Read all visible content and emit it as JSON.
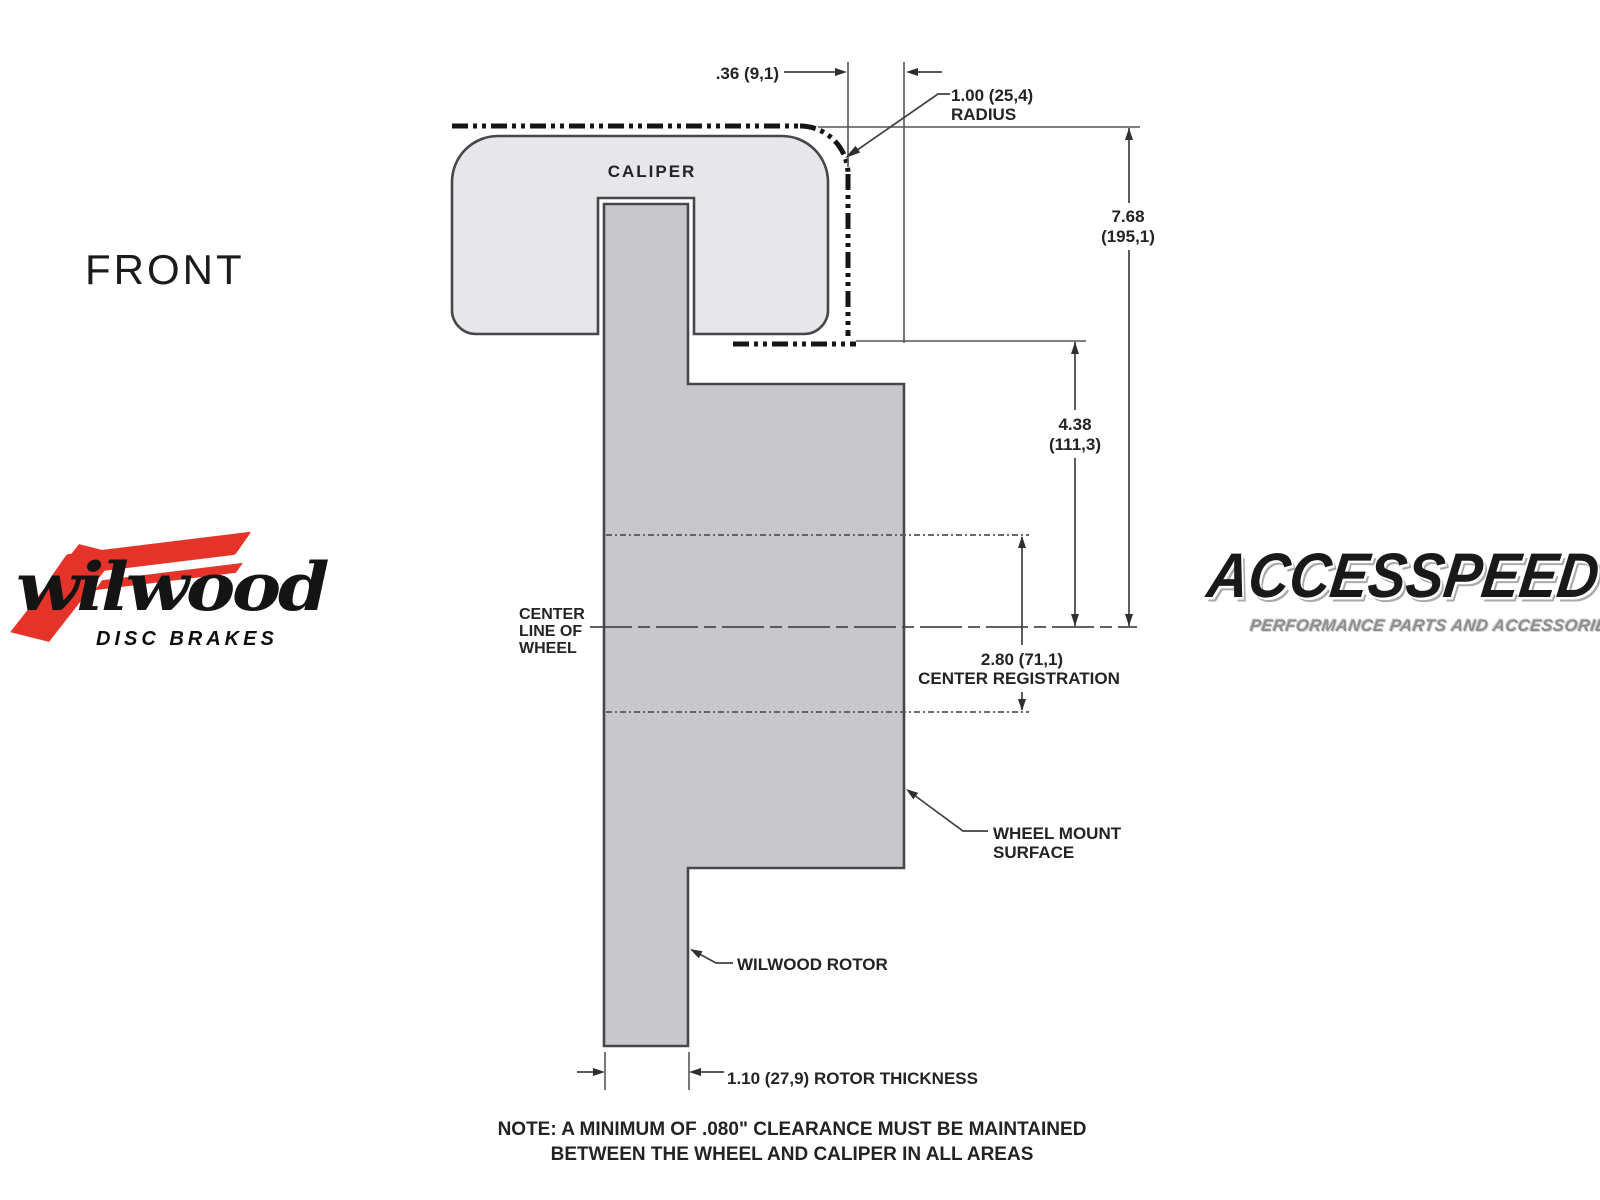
{
  "colors": {
    "background": "#ffffff",
    "caliper_fill": "#e7e7e9",
    "rotor_fill": "#c8c8cc",
    "outline": "#47474b",
    "dimension_lines": "#55555a",
    "phantom_line": "#151515",
    "text": "#232326",
    "wilwood_red": "#e63329",
    "logo_black": "#141414",
    "accesspeed_tagline_gray": "#8e8e8e"
  },
  "drawing": {
    "view_label": "FRONT",
    "caliper_label": "CALIPER",
    "dimensions": {
      "caliper_wheel_clearance": ".36 (9,1)",
      "corner_radius_value": "1.00 (25,4)",
      "corner_radius_word": "RADIUS",
      "overall_height_value": "7.68",
      "overall_height_metric": "(195,1)",
      "caliper_to_center_value": "4.38",
      "caliper_to_center_metric": "(111,3)",
      "center_registration_value": "2.80 (71,1)",
      "center_registration_label": "CENTER REGISTRATION",
      "rotor_thickness_label": "1.10 (27,9) ROTOR THICKNESS"
    },
    "callouts": {
      "centerline_line1": "CENTER",
      "centerline_line2": "LINE OF",
      "centerline_line3": "WHEEL",
      "wheel_mount_line1": "WHEEL MOUNT",
      "wheel_mount_line2": "SURFACE",
      "rotor_callout": "WILWOOD ROTOR"
    },
    "note_line1": "NOTE: A MINIMUM OF .080\" CLEARANCE MUST BE MAINTAINED",
    "note_line2": "BETWEEN THE WHEEL AND CALIPER IN ALL AREAS"
  },
  "logos": {
    "wilwood": {
      "wordmark": "wilwood",
      "tagline": "DISC BRAKES"
    },
    "accesspeed": {
      "wordmark": "ACCESSPEED",
      "tagline": "PERFORMANCE PARTS AND ACCESSORIES"
    }
  }
}
